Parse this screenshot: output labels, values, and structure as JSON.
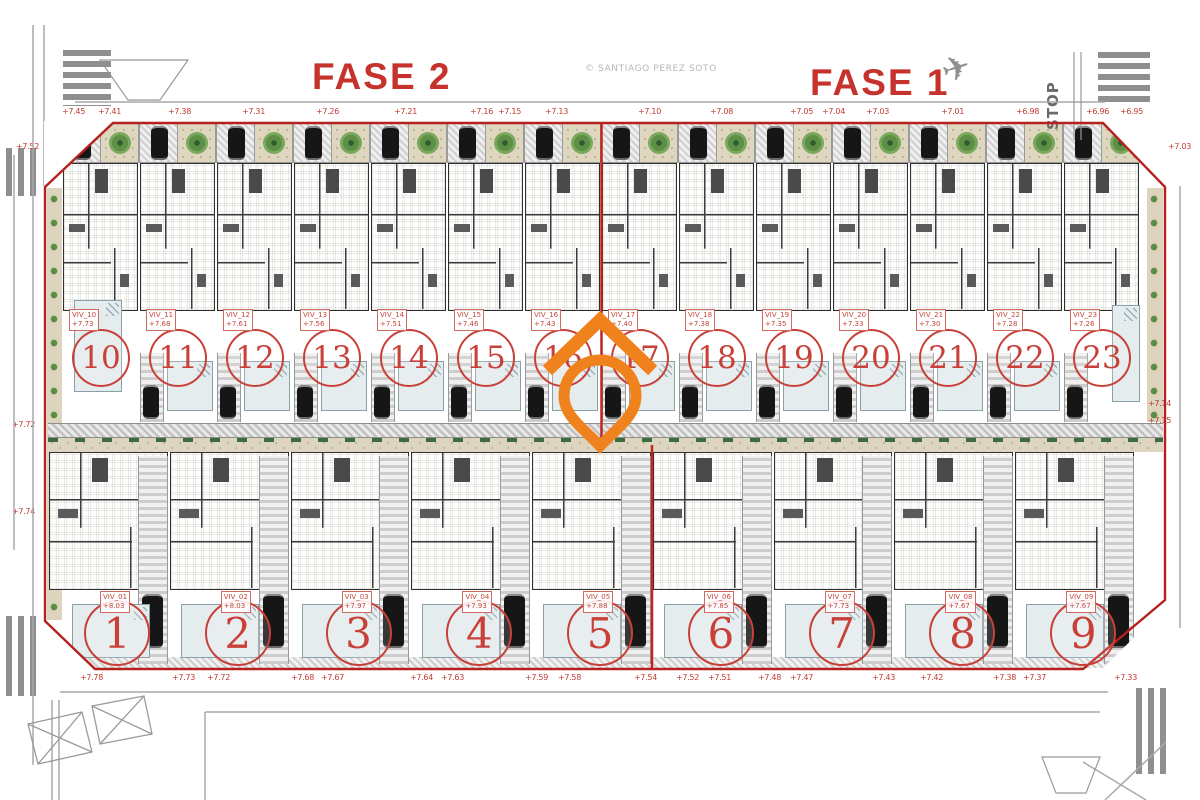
{
  "titles": {
    "fase2": "FASE 2",
    "fase1": "FASE 1"
  },
  "watermark": "© SANTIAGO PEREZ SOTO",
  "signs": {
    "stop": "STOP"
  },
  "icons": {
    "airplane": "✈"
  },
  "colors": {
    "phase_title_red": "#c5332c",
    "boundary_red": "#b5211c",
    "unit_number_red": "#c84038",
    "marker_orange": "#f0821e",
    "pool_blue": "#e4ecee",
    "garden_tan": "#dcd4bc",
    "shrub_green": "#3c6b41"
  },
  "top_row": {
    "units": [
      {
        "num": "10",
        "code": "VIV_10",
        "elev": "+7.73"
      },
      {
        "num": "11",
        "code": "VIV_11",
        "elev": "+7.68"
      },
      {
        "num": "12",
        "code": "VIV_12",
        "elev": "+7.61"
      },
      {
        "num": "13",
        "code": "VIV_13",
        "elev": "+7.56"
      },
      {
        "num": "14",
        "code": "VIV_14",
        "elev": "+7.51"
      },
      {
        "num": "15",
        "code": "VIV_15",
        "elev": "+7.46"
      },
      {
        "num": "16",
        "code": "VIV_16",
        "elev": "+7.43"
      },
      {
        "num": "17",
        "code": "VIV_17",
        "elev": "+7.40"
      },
      {
        "num": "18",
        "code": "VIV_18",
        "elev": "+7.38"
      },
      {
        "num": "19",
        "code": "VIV_19",
        "elev": "+7.35"
      },
      {
        "num": "20",
        "code": "VIV_20",
        "elev": "+7.33"
      },
      {
        "num": "21",
        "code": "VIV_21",
        "elev": "+7.30"
      },
      {
        "num": "22",
        "code": "VIV_22",
        "elev": "+7.28"
      },
      {
        "num": "23",
        "code": "VIV_23",
        "elev": "+7.26"
      }
    ]
  },
  "bottom_row": {
    "units": [
      {
        "num": "1",
        "code": "VIV_01",
        "elev": "+8.03"
      },
      {
        "num": "2",
        "code": "VIV_02",
        "elev": "+8.03"
      },
      {
        "num": "3",
        "code": "VIV_03",
        "elev": "+7.97"
      },
      {
        "num": "4",
        "code": "VIV_04",
        "elev": "+7.93"
      },
      {
        "num": "5",
        "code": "VIV_05",
        "elev": "+7.88"
      },
      {
        "num": "6",
        "code": "VIV_06",
        "elev": "+7.85"
      },
      {
        "num": "7",
        "code": "VIV_07",
        "elev": "+7.73"
      },
      {
        "num": "8",
        "code": "VIV_08",
        "elev": "+7.67"
      },
      {
        "num": "9",
        "code": "VIV_09",
        "elev": "+7.67"
      }
    ]
  },
  "elevation_labels": {
    "top": [
      {
        "text": "+7.45",
        "x": 62,
        "y": 107
      },
      {
        "text": "+7.41",
        "x": 98,
        "y": 107
      },
      {
        "text": "+7.38",
        "x": 168,
        "y": 107
      },
      {
        "text": "+7.31",
        "x": 242,
        "y": 107
      },
      {
        "text": "+7.26",
        "x": 316,
        "y": 107
      },
      {
        "text": "+7.21",
        "x": 394,
        "y": 107
      },
      {
        "text": "+7.16",
        "x": 470,
        "y": 107
      },
      {
        "text": "+7.15",
        "x": 498,
        "y": 107
      },
      {
        "text": "+7.13",
        "x": 545,
        "y": 107
      },
      {
        "text": "+7.10",
        "x": 638,
        "y": 107
      },
      {
        "text": "+7.08",
        "x": 710,
        "y": 107
      },
      {
        "text": "+7.05",
        "x": 790,
        "y": 107
      },
      {
        "text": "+7.04",
        "x": 822,
        "y": 107
      },
      {
        "text": "+7.03",
        "x": 866,
        "y": 107
      },
      {
        "text": "+7.01",
        "x": 941,
        "y": 107
      },
      {
        "text": "+6.98",
        "x": 1016,
        "y": 107
      },
      {
        "text": "+6.96",
        "x": 1086,
        "y": 107
      },
      {
        "text": "+6.95",
        "x": 1120,
        "y": 107
      }
    ],
    "bottom": [
      {
        "text": "+7.78",
        "x": 80,
        "y": 673
      },
      {
        "text": "+7.73",
        "x": 172,
        "y": 673
      },
      {
        "text": "+7.72",
        "x": 207,
        "y": 673
      },
      {
        "text": "+7.68",
        "x": 291,
        "y": 673
      },
      {
        "text": "+7.67",
        "x": 321,
        "y": 673
      },
      {
        "text": "+7.64",
        "x": 410,
        "y": 673
      },
      {
        "text": "+7.63",
        "x": 441,
        "y": 673
      },
      {
        "text": "+7.59",
        "x": 525,
        "y": 673
      },
      {
        "text": "+7.58",
        "x": 558,
        "y": 673
      },
      {
        "text": "+7.54",
        "x": 634,
        "y": 673
      },
      {
        "text": "+7.52",
        "x": 676,
        "y": 673
      },
      {
        "text": "+7.51",
        "x": 708,
        "y": 673
      },
      {
        "text": "+7.48",
        "x": 758,
        "y": 673
      },
      {
        "text": "+7.47",
        "x": 790,
        "y": 673
      },
      {
        "text": "+7.43",
        "x": 872,
        "y": 673
      },
      {
        "text": "+7.42",
        "x": 920,
        "y": 673
      },
      {
        "text": "+7.38",
        "x": 993,
        "y": 673
      },
      {
        "text": "+7.37",
        "x": 1023,
        "y": 673
      },
      {
        "text": "+7.33",
        "x": 1114,
        "y": 673
      }
    ],
    "left": [
      {
        "text": "+7.52",
        "x": 16,
        "y": 142
      },
      {
        "text": "+7.72",
        "x": 12,
        "y": 420
      },
      {
        "text": "+7.74",
        "x": 12,
        "y": 507
      }
    ],
    "right": [
      {
        "text": "+7.03",
        "x": 1168,
        "y": 142
      },
      {
        "text": "+7.14",
        "x": 1148,
        "y": 399
      },
      {
        "text": "+7.15",
        "x": 1148,
        "y": 416
      }
    ]
  }
}
